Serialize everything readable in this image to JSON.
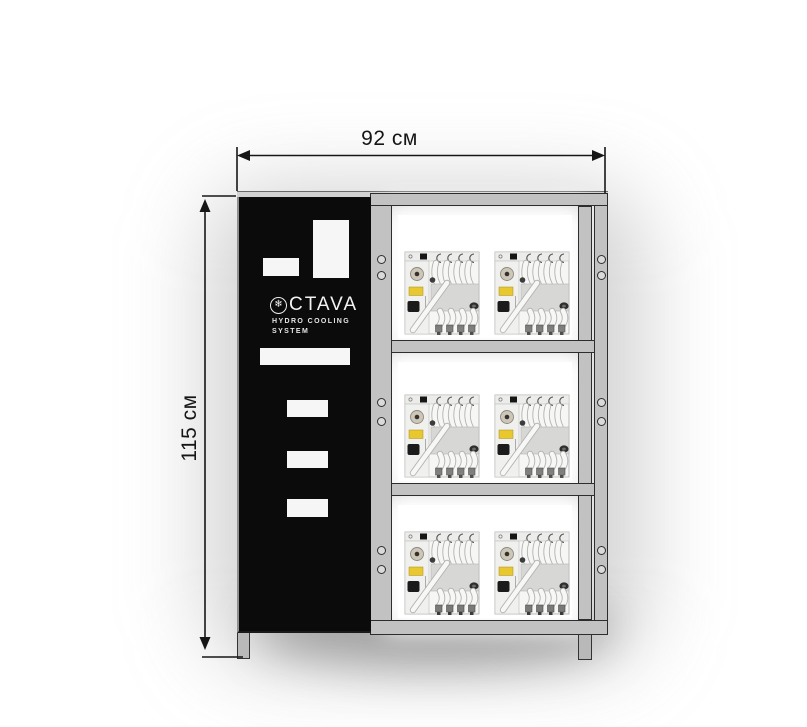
{
  "drawing": {
    "type": "product-dimension-diagram",
    "width_label": "92 см",
    "height_label": "115 см"
  },
  "panel": {
    "brand": "OCTAVA",
    "logo_icon": "snowflake-circle",
    "logo_text": "CTAVA",
    "subtitle_line1": "HYDRO COOLING",
    "subtitle_line2": "SYSTEM"
  },
  "rack": {
    "rows": 3,
    "machines_per_row": 2,
    "mounting_hole_pairs_per_row": 2
  },
  "icons": {
    "snowflake": "❄"
  },
  "theme": {
    "bg": "#ffffff",
    "panel_color": "#0b0b0b",
    "cutout_color": "#f6f6f6",
    "frame_fill": "#c2c2c2",
    "frame_outline": "#2d2d2d",
    "dim_color": "#151515",
    "machine_label_yellow": "#e9c72e"
  }
}
